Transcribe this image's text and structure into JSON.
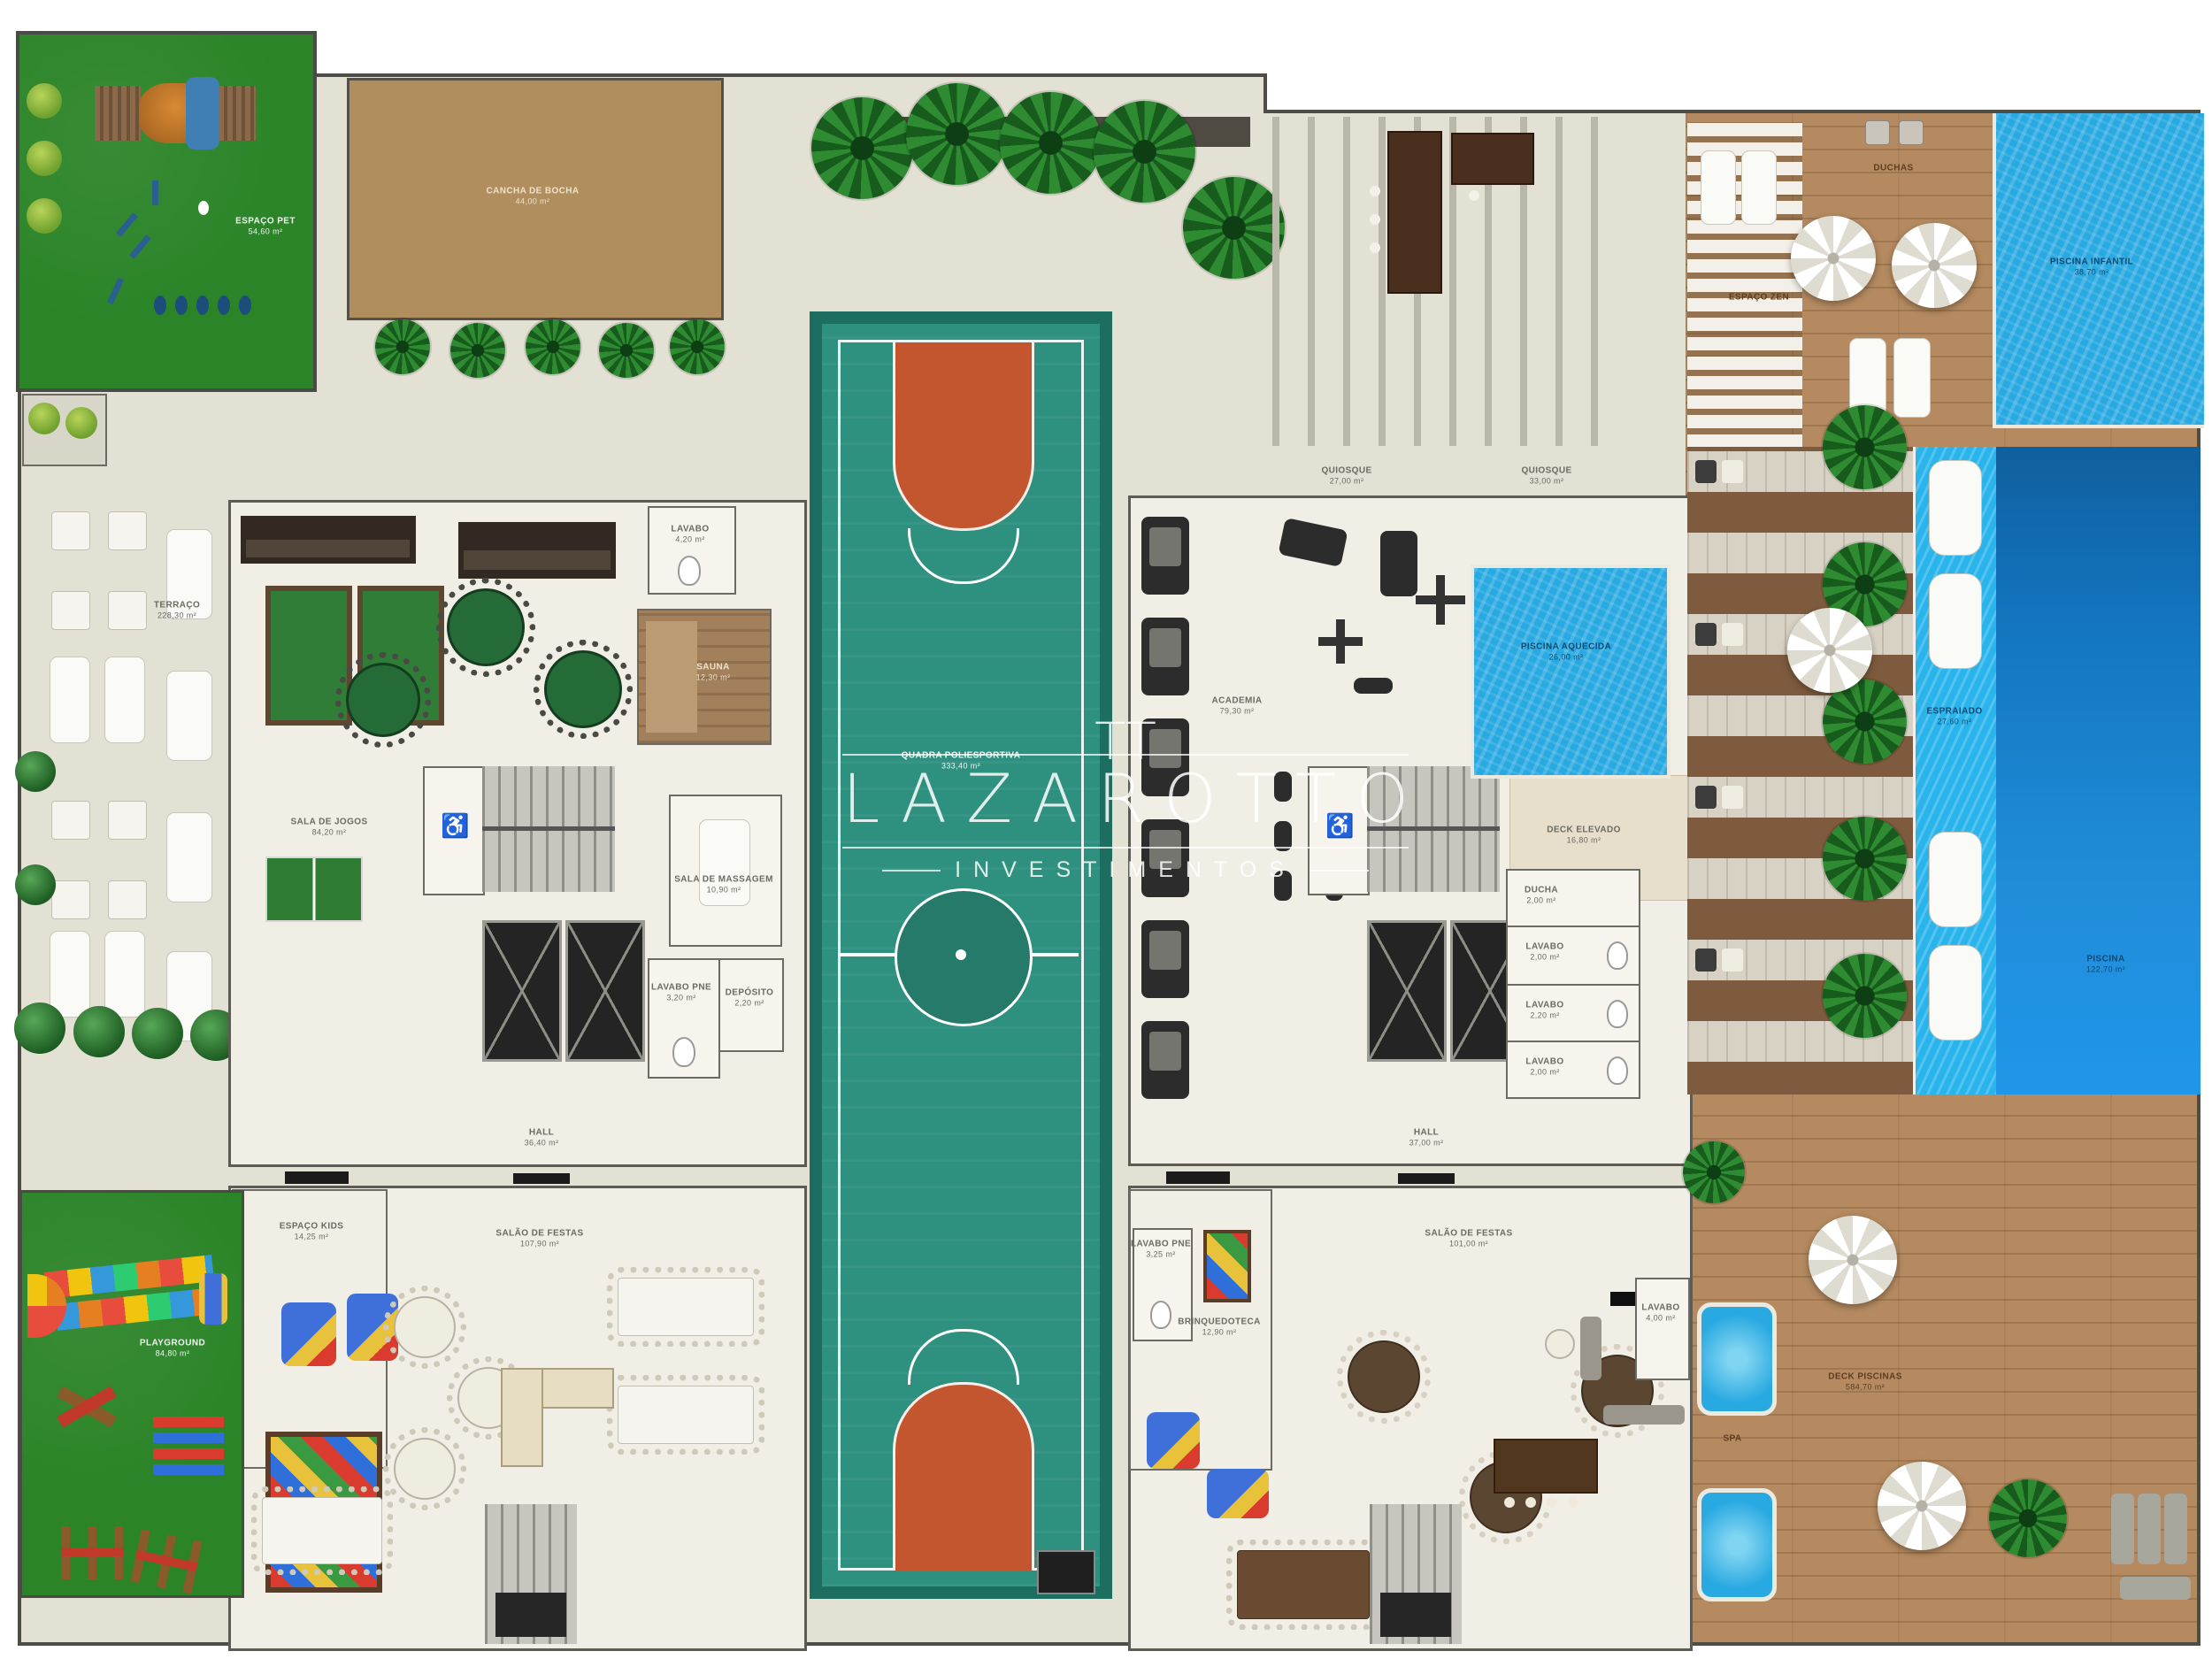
{
  "watermark": {
    "monogram": "TT",
    "brand": "LAZAROTTO",
    "subtitle": "INVESTIMENTOS"
  },
  "areas": {
    "espaco_pet": {
      "name": "ESPAÇO PET",
      "area": "54,60 m²"
    },
    "cancha_bocha": {
      "name": "CANCHA DE BOCHA",
      "area": "44,00 m²"
    },
    "terraco": {
      "name": "TERRAÇO",
      "area": "228,30 m²"
    },
    "lavabo_jogos": {
      "name": "LAVABO",
      "area": "4,20 m²"
    },
    "sauna": {
      "name": "SAUNA",
      "area": "12,30 m²"
    },
    "sala_jogos": {
      "name": "SALA DE JOGOS",
      "area": "84,20 m²"
    },
    "sala_massagem": {
      "name": "SALA DE MASSAGEM",
      "area": "10,90 m²"
    },
    "lavabo_pne_1": {
      "name": "LAVABO PNE",
      "area": "3,20 m²"
    },
    "deposito": {
      "name": "DEPÓSITO",
      "area": "2,20 m²"
    },
    "hall_1": {
      "name": "HALL",
      "area": "36,40 m²"
    },
    "quadra": {
      "name": "QUADRA POLIESPORTIVA",
      "area": "333,40 m²"
    },
    "quiosque_1": {
      "name": "QUIOSQUE",
      "area": "27,00 m²"
    },
    "quiosque_2": {
      "name": "QUIOSQUE",
      "area": "33,00 m²"
    },
    "academia": {
      "name": "ACADEMIA",
      "area": "79,30 m²"
    },
    "piscina_aquecida": {
      "name": "PISCINA AQUECIDA",
      "area": "26,00 m²"
    },
    "deck_elevado": {
      "name": "DECK ELEVADO",
      "area": "16,80 m²"
    },
    "ducha": {
      "name": "DUCHA",
      "area": "2,00 m²"
    },
    "lavabo_a": {
      "name": "LAVABO",
      "area": "2,00 m²"
    },
    "lavabo_b": {
      "name": "LAVABO",
      "area": "2,20 m²"
    },
    "lavabo_c": {
      "name": "LAVABO",
      "area": "2,00 m²"
    },
    "hall_2": {
      "name": "HALL",
      "area": "37,00 m²"
    },
    "espaco_kids": {
      "name": "ESPAÇO KIDS",
      "area": "14,25 m²"
    },
    "salao_festas_1": {
      "name": "SALÃO DE FESTAS",
      "area": "107,90 m²"
    },
    "playground": {
      "name": "PLAYGROUND",
      "area": "84,80 m²"
    },
    "lavabo_pne_2": {
      "name": "LAVABO PNE",
      "area": "3,25 m²"
    },
    "brinquedoteca": {
      "name": "BRINQUEDOTECA",
      "area": "12,90 m²"
    },
    "salao_festas_2": {
      "name": "SALÃO DE FESTAS",
      "area": "101,00 m²"
    },
    "lavabo_d": {
      "name": "LAVABO",
      "area": "4,00 m²"
    },
    "duchas": {
      "name": "DUCHAS"
    },
    "espaco_zen": {
      "name": "ESPAÇO ZEN"
    },
    "piscina_infantil": {
      "name": "PISCINA INFANTIL",
      "area": "38,70 m²"
    },
    "espraiado": {
      "name": "ESPRAIADO",
      "area": "27,60 m²"
    },
    "piscina": {
      "name": "PISCINA",
      "area": "122,70 m²"
    },
    "deck_piscinas": {
      "name": "DECK PISCINAS",
      "area": "584,70 m²"
    },
    "spa": {
      "name": "SPA"
    }
  },
  "colors": {
    "lawn": "#2b8428",
    "court": "#2e9180",
    "court_border": "#1d6e60",
    "key_orange": "#c4562f",
    "pool_blue": "#29a9e1",
    "deep_pool": "#1477c2",
    "deck_wood": "#b58a60",
    "bocha_tan": "#b18e5e",
    "paving": "#e3e0d4",
    "watermark_white": "#ffffff"
  }
}
